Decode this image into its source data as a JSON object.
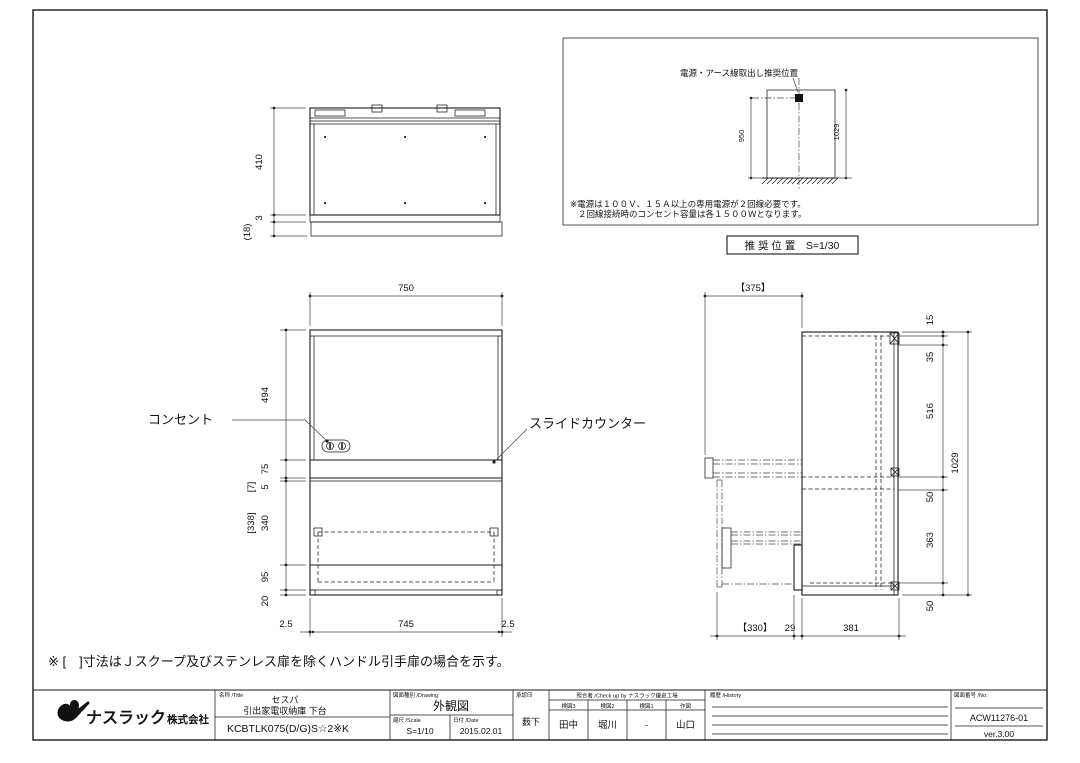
{
  "top_view": {
    "dim_410": "410",
    "dim_3": "3",
    "dim_18": "(18)"
  },
  "power_box": {
    "label": "電源・アース線取出し推奨位置",
    "dim_950": "950",
    "dim_1029": "1029",
    "note_line1": "※電源は１００Ｖ、１５Ａ以上の専用電源が２回線必要です。",
    "note_line2": "２回線接続時のコンセント容量は各１５００Ｗとなります。",
    "caption": "推 奨 位 置　S=1/30"
  },
  "front_view": {
    "dim_750": "750",
    "dim_494": "494",
    "dim_75": "75",
    "dim_7": "[7]",
    "dim_5": "5",
    "dim_338": "[338]",
    "dim_340": "340",
    "dim_95": "95",
    "dim_20": "20",
    "dim_2_5_left": "2.5",
    "dim_745": "745",
    "dim_2_5_right": "2.5",
    "label_outlet": "コンセント",
    "label_slide_counter": "スライドカウンター"
  },
  "side_view": {
    "dim_375": "【375】",
    "dim_15": "15",
    "dim_35": "35",
    "dim_516": "516",
    "dim_1029": "1029",
    "dim_50_top": "50",
    "dim_363": "363",
    "dim_50_bottom": "50",
    "dim_330": "【330】",
    "dim_29": "29",
    "dim_381": "381"
  },
  "note": "※ [　]寸法はＪスクープ及びステンレス扉を除くハンドル引手扉の場合を示す。",
  "title_block": {
    "company": "ナスラック",
    "company_suffix": "株式会社",
    "title_label": "名称 /Title",
    "product_series": "セスパ",
    "product_name": "引出家電収納庫 下台",
    "model": "KCBTLK075(D/G)S☆2※K",
    "drawing_label": "図面種別 /Drawing",
    "drawing_type": "外観図",
    "scale_label": "縮尺 /Scale",
    "scale": "S=1/10",
    "date_label": "日付 /Date",
    "date": "2015.02.01",
    "approval_label": "承認印",
    "approval": "薮下",
    "check_label": "照合者 /Check up by ナスラック鎌倉工場",
    "check_cols": [
      "検図3",
      "検図2",
      "検図1",
      "作図"
    ],
    "check_values": [
      "田中",
      "堀川",
      "-",
      "山口"
    ],
    "history_label": "履歴 /History",
    "number_label": "図面番号 /No.",
    "drawing_number": "ACW11276-01",
    "version": "ver.3.00"
  }
}
